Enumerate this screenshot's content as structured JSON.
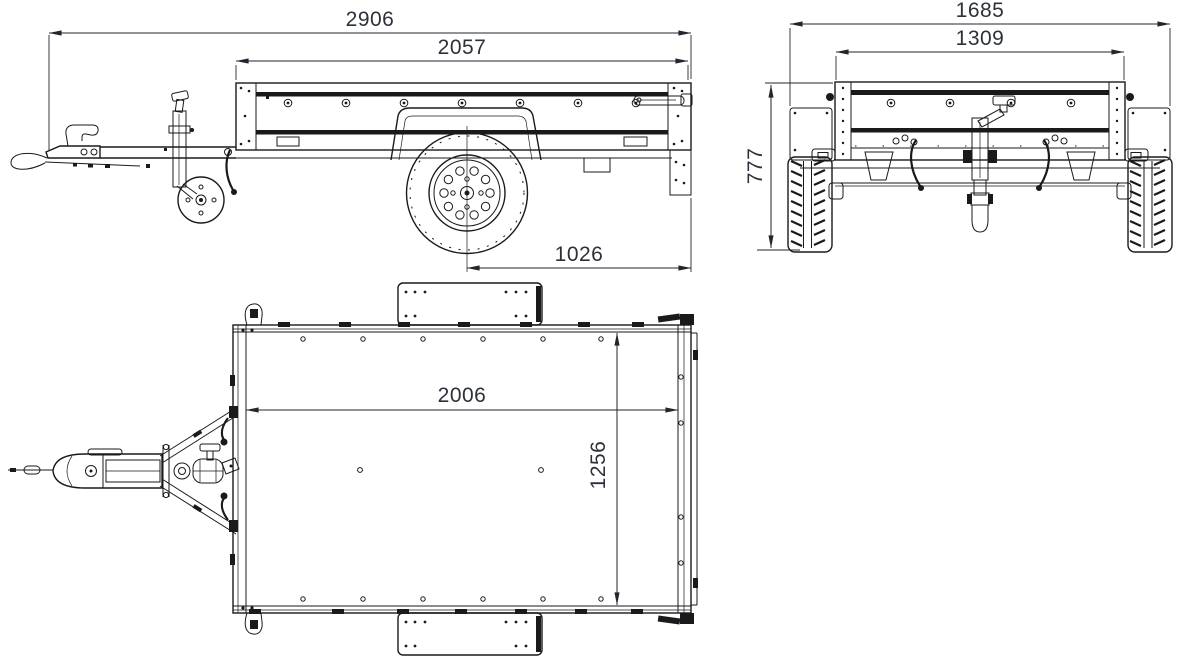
{
  "canvas": {
    "background": "#ffffff",
    "line_color": "#1a1a1c",
    "dim_text_color": "#2d313a"
  },
  "views": {
    "side": {
      "dims": {
        "overall_length": "2906",
        "box_length": "2057",
        "axle_to_rear": "1026"
      }
    },
    "rear": {
      "dims": {
        "overall_width": "1685",
        "inner_width": "1309",
        "height": "777"
      }
    },
    "top": {
      "dims": {
        "bed_length": "2006",
        "bed_width": "1256"
      }
    }
  }
}
